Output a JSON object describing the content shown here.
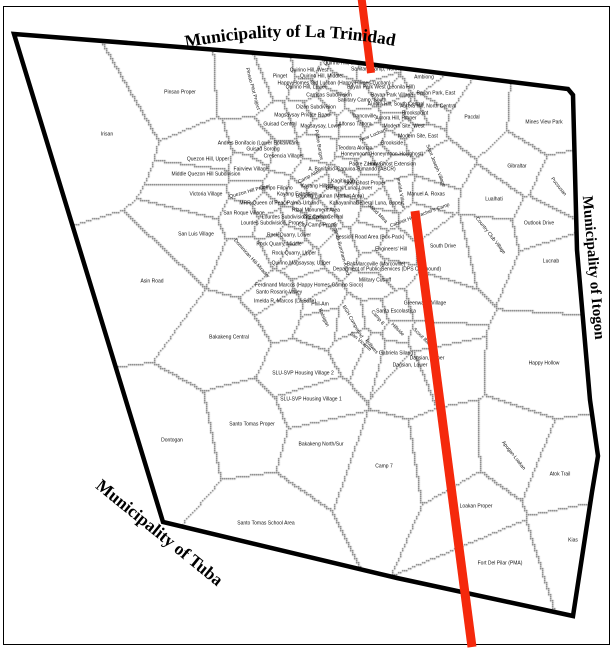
{
  "map": {
    "title_labels": {
      "top": "Municipality of La Trinidad",
      "right": "Municipality of Itogon",
      "bottom_left": "Municipality of Tuba"
    },
    "colors": {
      "route": "#f5290c",
      "boundary": "#000000",
      "parcel_line": "#5a5a5a",
      "frame": "#000000",
      "background": "#ffffff",
      "label_text": "#111111"
    },
    "route_segments": [
      {
        "x1": 361,
        "y1": -6,
        "x2": 371,
        "y2": 73,
        "w": 8
      },
      {
        "x1": 415,
        "y1": 211,
        "x2": 472,
        "y2": 647,
        "w": 9
      }
    ],
    "city_boundary": [
      [
        14,
        34
      ],
      [
        320,
        58
      ],
      [
        568,
        89
      ],
      [
        573,
        95
      ],
      [
        577,
        250
      ],
      [
        590,
        400
      ],
      [
        598,
        456
      ],
      [
        592,
        492
      ],
      [
        573,
        616
      ],
      [
        397,
        578
      ],
      [
        163,
        522
      ]
    ],
    "barangays": [
      [
        "Quirino Hill, East",
        342,
        64
      ],
      [
        "Quirino Hill, West",
        309,
        71
      ],
      [
        "Sanitary Camp, North",
        375,
        70
      ],
      [
        "Pinget",
        280,
        77
      ],
      [
        "Quirino Hill, Middle",
        321,
        77
      ],
      [
        "Ambiong",
        424,
        78
      ],
      [
        "Happy Homes Old Lucban (Happy Homes-Lucban)",
        334,
        84
      ],
      [
        "Quirino Hill, Lower",
        306,
        88
      ],
      [
        "Bayan Park West (Leonila Hill)",
        381,
        88
      ],
      [
        "Camdas Subdivision",
        329,
        96
      ],
      [
        "Bayan Park Village",
        392,
        96
      ],
      [
        "Bayan Park, East",
        436,
        94
      ],
      [
        "Sanitary Camp, South",
        362,
        101
      ],
      [
        "Dizon Subdivision",
        316,
        108
      ],
      [
        "Aurora Hill, South Central",
        396,
        105
      ],
      [
        "Aurora Hill, North Central",
        428,
        107
      ],
      [
        "Brookspoint",
        415,
        114
      ],
      [
        "Magsaysay Private Road",
        302,
        116
      ],
      [
        "Trancoville",
        364,
        117
      ],
      [
        "Aurora Hill, Proper",
        396,
        119
      ],
      [
        "Guisad Central",
        280,
        125
      ],
      [
        "Magsaysay, Lower",
        321,
        127
      ],
      [
        "Alfonso Tabora",
        355,
        125
      ],
      [
        "Modern Site, West",
        404,
        127
      ],
      [
        "Modern Site, East",
        418,
        137
      ],
      [
        "Pacdal",
        472,
        118
      ],
      [
        "Mines View Park",
        544,
        123
      ],
      [
        "New Lucban",
        373,
        136,
        -22
      ],
      [
        "Brookside",
        392,
        144
      ],
      [
        "Pinsao Proper",
        180,
        93
      ],
      [
        "Irisan",
        107,
        135
      ],
      [
        "Pinsao Pilot Project",
        252,
        89,
        75
      ],
      [
        "Andres Bonifacio (Lower Bokawkan)",
        258,
        144
      ],
      [
        "Guisad Sorong",
        263,
        150
      ],
      [
        "Cresencia Village",
        283,
        157
      ],
      [
        "Quezon Hill, Upper",
        208,
        160
      ],
      [
        "Fairview Village",
        251,
        170
      ],
      [
        "Middle Quezon Hill Subdivision",
        206,
        175
      ],
      [
        "Campo Filipino",
        276,
        189
      ],
      [
        "Quezon Hill Proper",
        250,
        192,
        -15
      ],
      [
        "Kayang Extension",
        297,
        195
      ],
      [
        "Bagong Lipunan (Market Area)",
        330,
        197
      ],
      [
        "Victoria Village",
        206,
        195
      ],
      [
        "Camp Allen",
        310,
        177,
        -28
      ],
      [
        "Kayang Hilltop",
        317,
        187
      ],
      [
        "Padre Burgos",
        318,
        145,
        80
      ],
      [
        "Padre Zamora",
        365,
        165
      ],
      [
        "Teodora Alonzo",
        355,
        149
      ],
      [
        "Honeymoon (Honeymoon-Holyghost)",
        382,
        155
      ],
      [
        "Holy Ghost Extension",
        392,
        165
      ],
      [
        "Holy Ghost Proper",
        365,
        184
      ],
      [
        "Kagitingan",
        343,
        182
      ],
      [
        "A. Bonifacio-Caguioa-Rimando (ABCR)",
        352,
        170
      ],
      [
        "General Luna, Lower",
        349,
        189
      ],
      [
        "General Luna, Upper",
        379,
        204
      ],
      [
        "Kabayanihan",
        344,
        204
      ],
      [
        "Salud Mitra",
        377,
        214,
        45
      ],
      [
        "Cabinet Hill-Teacher's Camp",
        420,
        216,
        -20
      ],
      [
        "Imelda Village",
        400,
        193,
        80
      ],
      [
        "Session Road Area (Box-Pack)",
        370,
        238
      ],
      [
        "Engineers' Hill",
        391,
        250
      ],
      [
        "Bal-Marcoville (Marcoville)",
        376,
        265
      ],
      [
        "Department of Public Services (DPS Compound)",
        387,
        270
      ],
      [
        "Military Cut-off",
        375,
        281
      ],
      [
        "Rizal Monument Area",
        316,
        211
      ],
      [
        "Palma-Urbano",
        303,
        204
      ],
      [
        "Lourdes Subdivision Extension",
        296,
        218
      ],
      [
        "Lourdes Subdivision, Proper",
        272,
        224
      ],
      [
        "City Camp Central",
        323,
        218
      ],
      [
        "City Camp Proper",
        318,
        226
      ],
      [
        "Rock Quarry, Lower",
        289,
        236
      ],
      [
        "Rock Quarry, Middle",
        279,
        245
      ],
      [
        "Rock Quarry, Upper",
        294,
        254
      ],
      [
        "Dominican Hill-Mirador",
        251,
        259,
        48
      ],
      [
        "Quirino Magsaysay, Upper",
        301,
        264
      ],
      [
        "Legarda-Burnham-Kisad",
        340,
        249,
        75
      ],
      [
        "Ferdinand Marcos (Happy Homes-Campo Sioco)",
        309,
        286
      ],
      [
        "Santo Rosario Valley",
        279,
        293
      ],
      [
        "Imelda R. Marcos (La Salle)",
        285,
        302
      ],
      [
        "Phil-Am",
        320,
        305
      ],
      [
        "BGH Compound",
        352,
        322,
        60
      ],
      [
        "San Vicente",
        360,
        342,
        40
      ],
      [
        "Balsigan",
        323,
        318,
        65
      ],
      [
        "Camp 8",
        377,
        318,
        50
      ],
      [
        "Santa Escolastica",
        396,
        312
      ],
      [
        "Greenwater Village",
        425,
        304
      ],
      [
        "Hillside",
        397,
        330,
        45
      ],
      [
        "Scout Barrio",
        423,
        339,
        45
      ],
      [
        "Gabriela Silang",
        396,
        354
      ],
      [
        "Dagsian, Upper",
        427,
        359
      ],
      [
        "Dagsian, Lower",
        410,
        366
      ],
      [
        "Poliwes",
        371,
        347,
        50
      ],
      [
        "SLU-SVP Housing Village 2",
        303,
        374
      ],
      [
        "SLU-SVP Housing Village 1",
        311,
        400
      ],
      [
        "Bakakeng Central",
        229,
        338
      ],
      [
        "Santo Tomas Proper",
        252,
        425
      ],
      [
        "Dontogan",
        172,
        441
      ],
      [
        "Bakakeng North/Sur",
        321,
        445
      ],
      [
        "Camp 7",
        384,
        467
      ],
      [
        "Santo Tomas School Area",
        266,
        524
      ],
      [
        "Liwanag-Loakan",
        447,
        457,
        78
      ],
      [
        "Loakan Proper",
        476,
        507
      ],
      [
        "Apugan-Loakan",
        513,
        456,
        52
      ],
      [
        "Atok Trail",
        560,
        475
      ],
      [
        "Kias",
        573,
        541
      ],
      [
        "Fort Del Pilar (PMA)",
        500,
        564
      ],
      [
        "Happy Hollow",
        544,
        364
      ],
      [
        "Lucnab",
        551,
        262
      ],
      [
        "Outlook Drive",
        539,
        224
      ],
      [
        "Country Club Village",
        490,
        236,
        52
      ],
      [
        "South Drive",
        443,
        247
      ],
      [
        "Lualhati",
        494,
        200
      ],
      [
        "Manuel A. Roxas",
        426,
        195
      ],
      [
        "Saint Joseph Village",
        435,
        166,
        68
      ],
      [
        "Gibraltar",
        517,
        167
      ],
      [
        "Pucsusan",
        558,
        187,
        52
      ],
      [
        "San Luis Village",
        196,
        235
      ],
      [
        "San Roque Village",
        244,
        214
      ],
      [
        "MRR-Queen of Peace",
        264,
        204
      ],
      [
        "Asin Road",
        152,
        282
      ]
    ]
  }
}
